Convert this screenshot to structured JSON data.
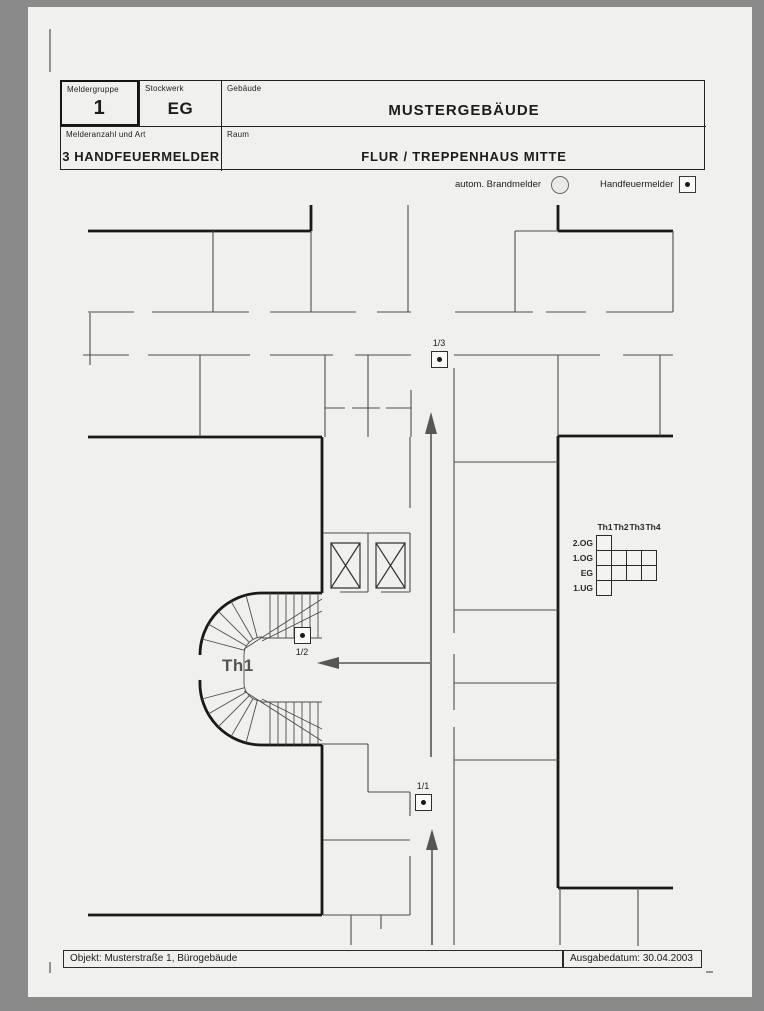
{
  "title_block": {
    "fields": [
      {
        "label": "Meldergruppe",
        "value": "1"
      },
      {
        "label": "Stockwerk",
        "value": "EG"
      },
      {
        "label": "Gebäude",
        "value": "MUSTERGEBÄUDE"
      },
      {
        "label": "Melderanzahl und Art",
        "value": "3 HANDFEUERMELDER"
      },
      {
        "label": "Raum",
        "value": "FLUR / TREPPENHAUS MITTE"
      }
    ]
  },
  "legend": {
    "auto_detector_label": "autom. Brandmelder",
    "manual_detector_label": "Handfeuermelder"
  },
  "plan": {
    "stairwell_label": "Th1",
    "detectors": [
      {
        "id": "1/3",
        "x": 431,
        "y": 351,
        "label_pos": "above"
      },
      {
        "id": "1/2",
        "x": 294,
        "y": 627,
        "label_pos": "below"
      },
      {
        "id": "1/1",
        "x": 415,
        "y": 794,
        "label_pos": "above"
      }
    ]
  },
  "floor_matrix": {
    "columns": [
      "Th1",
      "Th2",
      "Th3",
      "Th4"
    ],
    "rows": [
      {
        "label": "2.OG",
        "cells": 1
      },
      {
        "label": "1.OG",
        "cells": 4
      },
      {
        "label": "EG",
        "cells": 4
      },
      {
        "label": "1.UG",
        "cells": 1
      }
    ]
  },
  "footer": {
    "object_label": "Objekt: Musterstraße 1, Bürogebäude",
    "date_label": "Ausgabedatum: 30.04.2003"
  },
  "colors": {
    "page_background": "#f0f0ee",
    "frame": "#8a8a8a",
    "wall_thick": "#191919",
    "wall_thin": "#4d4d4d",
    "arrow": "#565656"
  }
}
